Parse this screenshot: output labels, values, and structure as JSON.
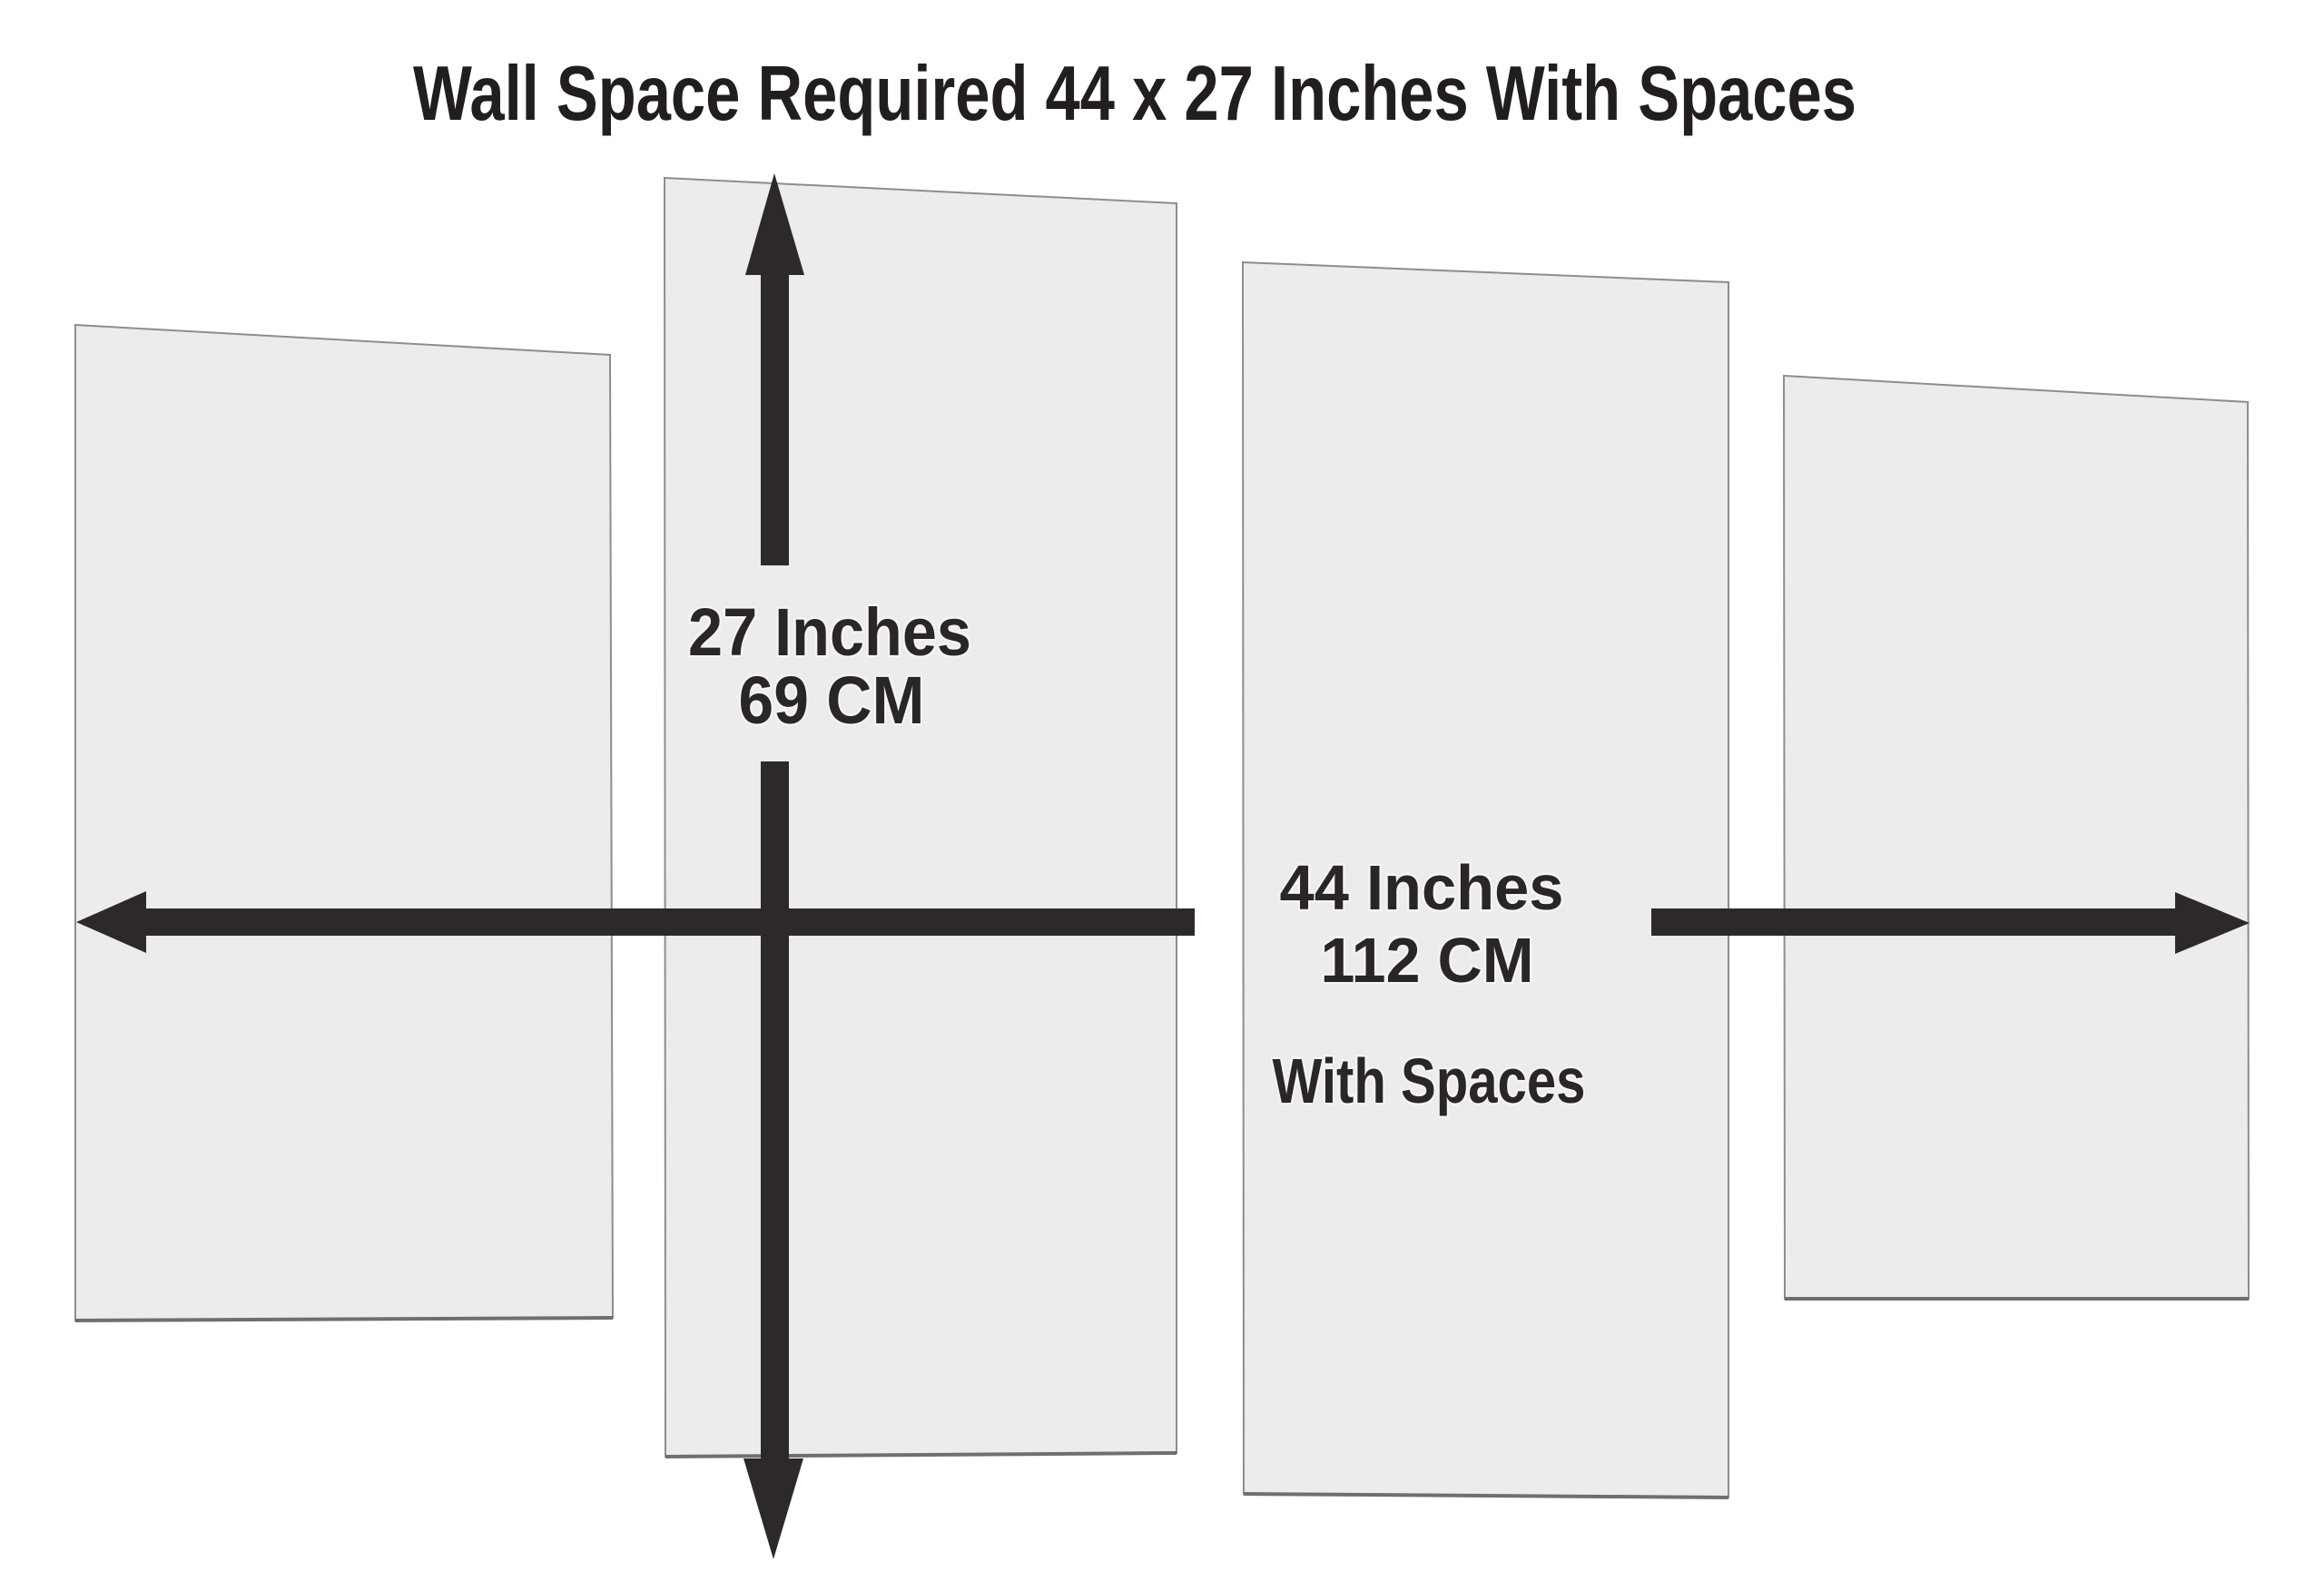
{
  "title": "Wall Space Required 44 x 27 Inches With Spaces",
  "dimensions": {
    "height": {
      "inches": "27 Inches",
      "cm": "69 CM"
    },
    "width": {
      "inches": "44 Inches",
      "cm": "112 CM",
      "note": "With Spaces"
    }
  },
  "panel_count": "4",
  "colors": {
    "background": "#ffffff",
    "panel_fill": "#ebeceb",
    "panel_border": "#8d8d8d",
    "panel_bottom_edge": "#6f6f6f",
    "arrow": "#2e2929",
    "title_text": "#221e1f",
    "label_text": "#2a2526",
    "label_halo": "#f4f4f3"
  }
}
